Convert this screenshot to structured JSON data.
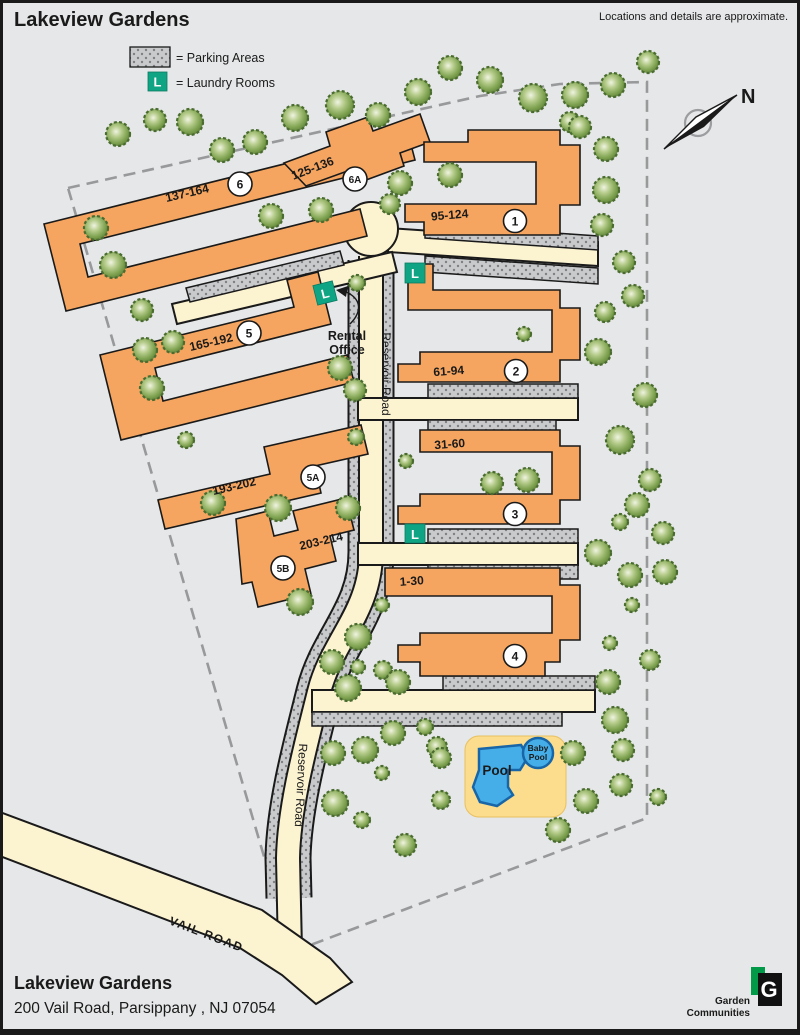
{
  "title": "Lakeview Gardens",
  "disclaimer": "Locations and details are approximate.",
  "legend": {
    "parking_label": "= Parking Areas",
    "laundry_label": "= Laundry Rooms",
    "laundry_letter": "L"
  },
  "compass": {
    "north": "N"
  },
  "buildings": [
    {
      "number": "6",
      "units": "137-164"
    },
    {
      "number": "6A",
      "units": "125-136"
    },
    {
      "number": "1",
      "units": "95-124"
    },
    {
      "number": "5",
      "units": "165-192"
    },
    {
      "number": "2",
      "units": "61-94"
    },
    {
      "number": "5A",
      "units": "193-202"
    },
    {
      "number": "3",
      "units": "31-60"
    },
    {
      "number": "5B",
      "units": "203-214"
    },
    {
      "number": "4",
      "units": "1-30"
    }
  ],
  "roads": {
    "reservoir": "Reservoir Road",
    "vail": "VAIL ROAD"
  },
  "rental_office": {
    "line1": "Rental",
    "line2": "Office"
  },
  "pool": {
    "main": "Pool",
    "baby_line1": "Baby",
    "baby_line2": "Pool"
  },
  "footer": {
    "name": "Lakeview Gardens",
    "address": "200 Vail Road, Parsippany , NJ 07054"
  },
  "logo": {
    "letter": "G",
    "line1": "Garden",
    "line2": "Communities"
  },
  "colors": {
    "background": "#E6E7E8",
    "building": "#F5A55F",
    "road": "#FCF3D1",
    "parking_base": "#C9CACC",
    "parking_dot": "#7E8083",
    "laundry": "#0FA483",
    "pool_deck": "#FBDD8D",
    "pool_water": "#45AEE8",
    "pool_border": "#1866A8",
    "boundary": "#97999B",
    "outline": "#1A1A1A",
    "tree_edge": "#4A6C30",
    "logo_green": "#009A49",
    "logo_black": "#111111"
  }
}
